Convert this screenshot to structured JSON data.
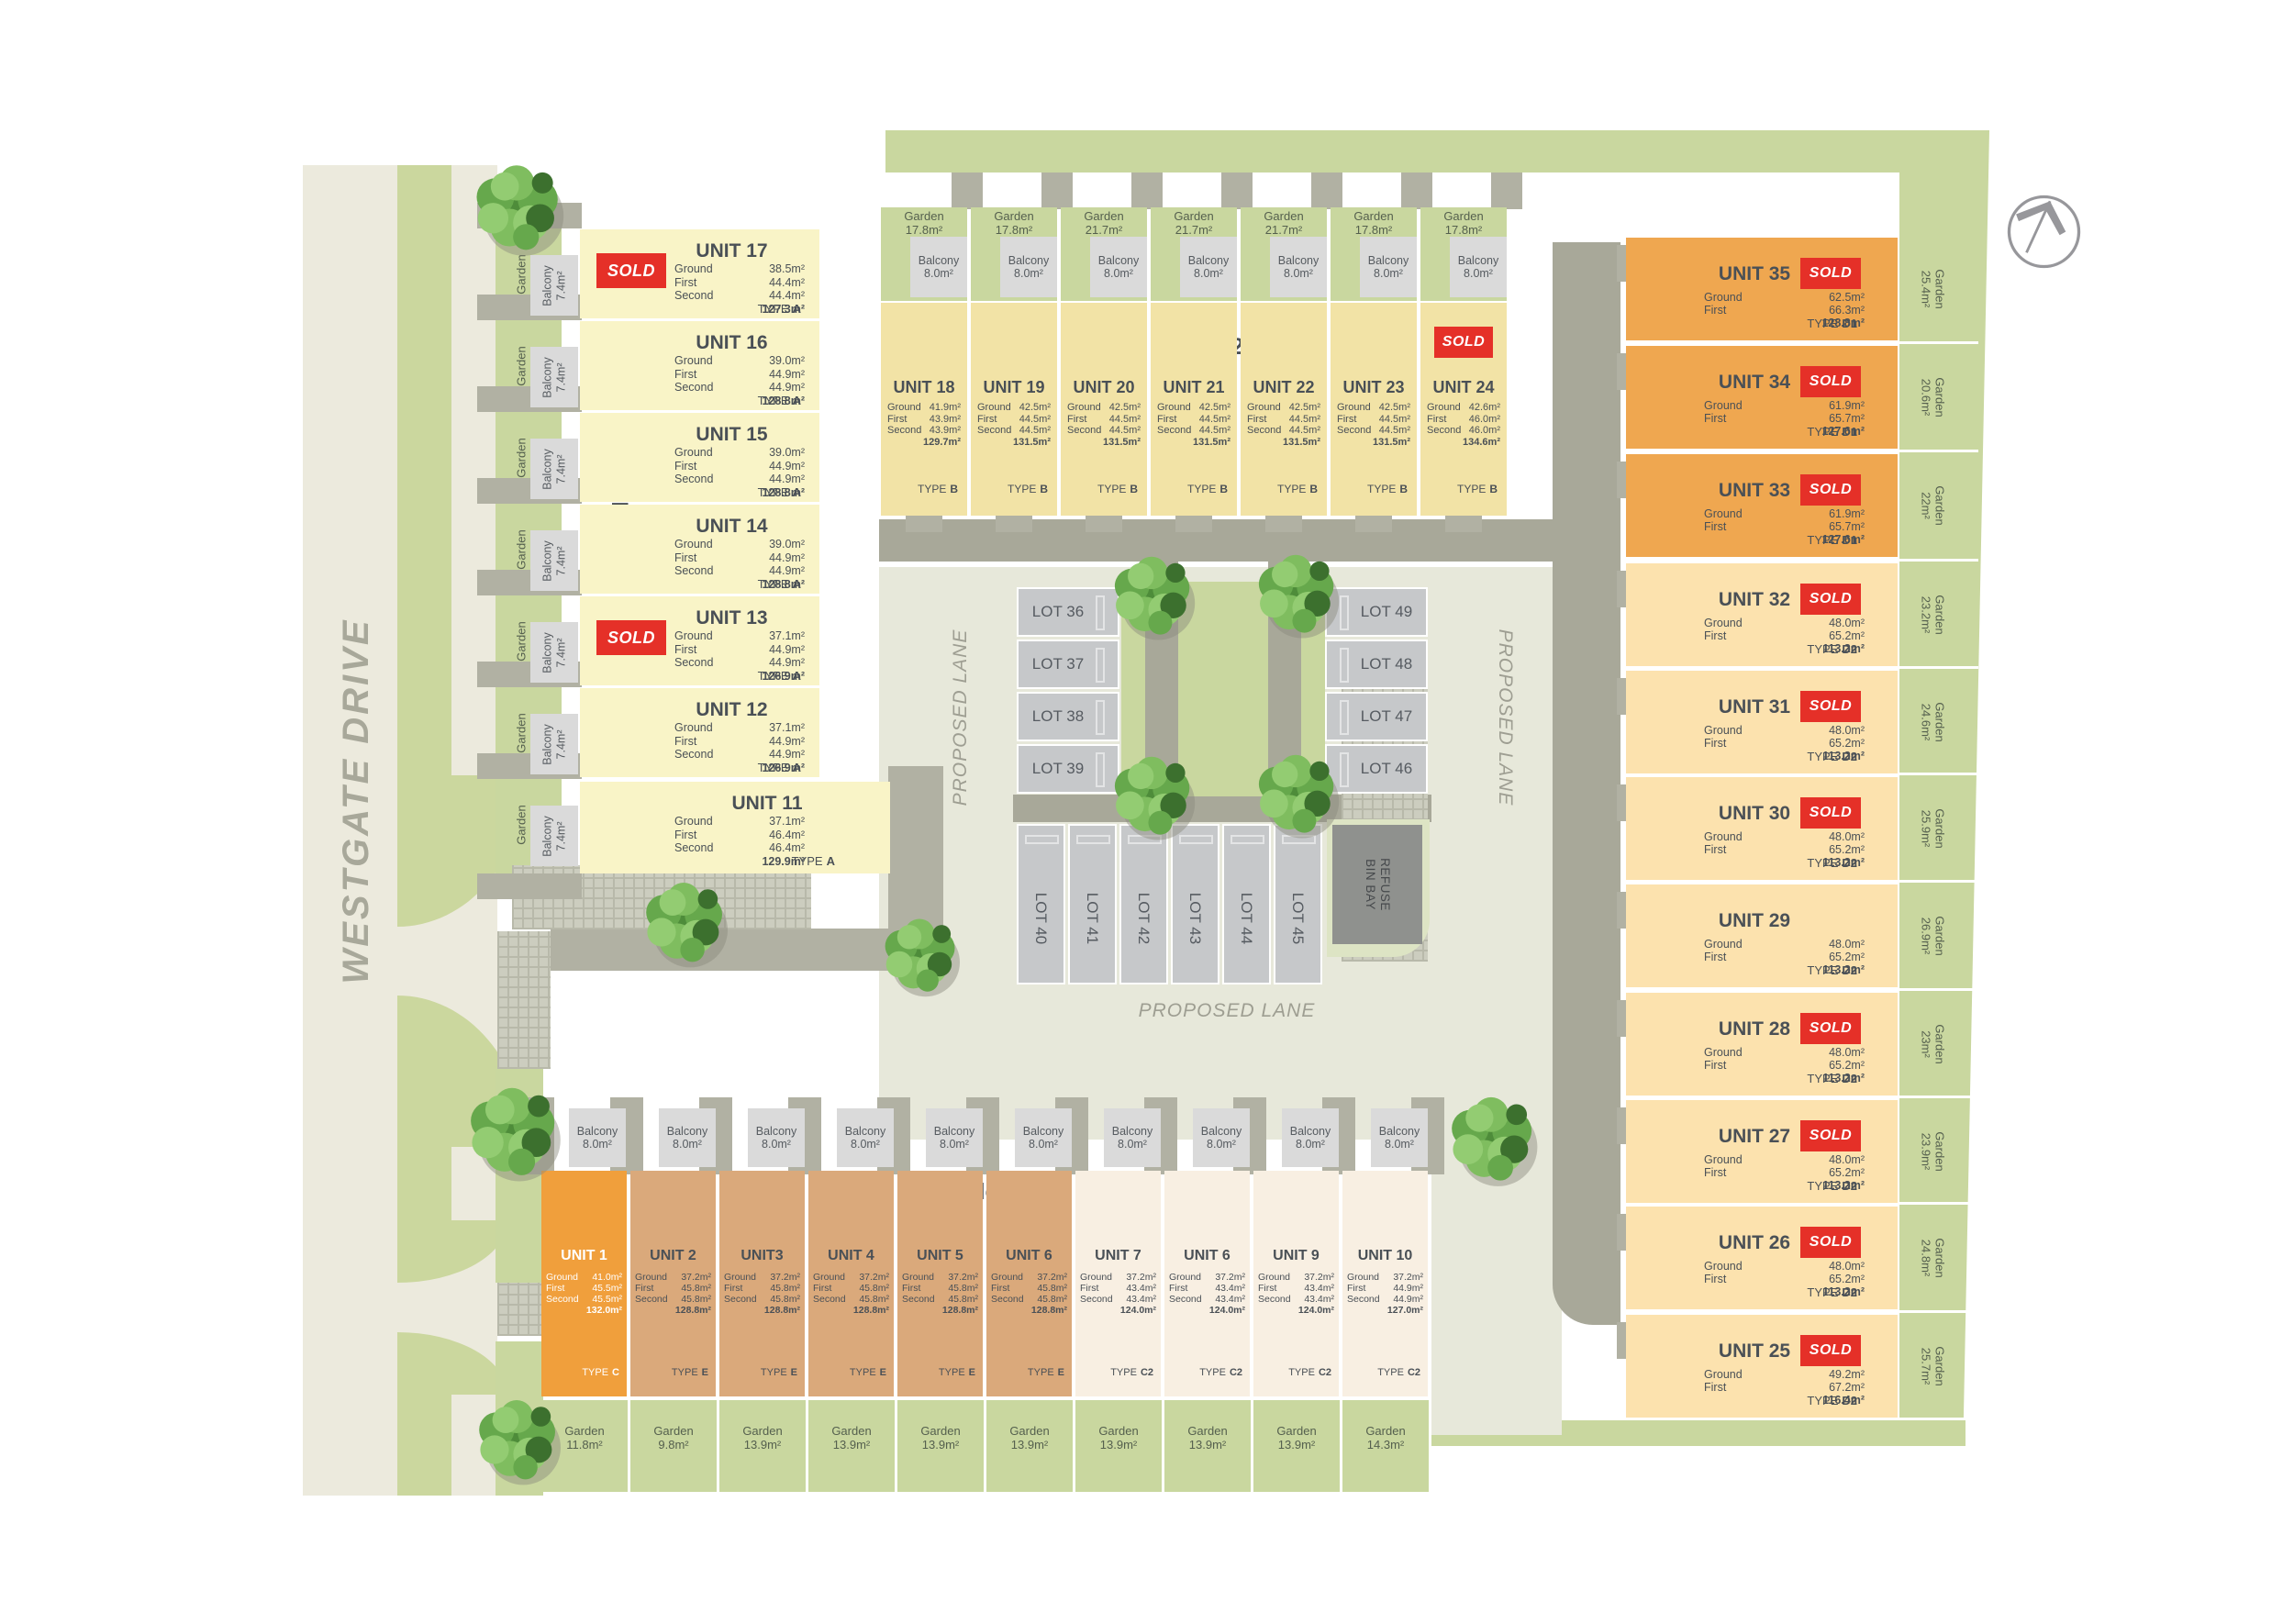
{
  "site": {
    "road_label": "WESTGATE DRIVE",
    "lane_left": "PROPOSED LANE",
    "lane_right": "PROPOSED LANE",
    "lane_bottom": "PROPOSED LANE",
    "refuse_line1": "REFUSE",
    "refuse_line2": "BIN BAY",
    "sold": "SOLD"
  },
  "labels": {
    "ground": "Ground",
    "first": "First",
    "second": "Second",
    "garden": "Garden",
    "balcony": "Balcony",
    "type": "TYPE"
  },
  "lots": {
    "left": [
      "LOT 36",
      "LOT 37",
      "LOT 38",
      "LOT 39"
    ],
    "right": [
      "LOT 49",
      "LOT 48",
      "LOT 47",
      "LOT 46"
    ],
    "bottom": [
      "LOT 40",
      "LOT 41",
      "LOT 42",
      "LOT 43",
      "LOT 44",
      "LOT 45"
    ]
  },
  "blocks": [
    {
      "label": "Block 1",
      "units": [
        {
          "name": "UNIT 17",
          "ground": "38.5m²",
          "first": "44.4m²",
          "second": "44.4m²",
          "total": "127.3m²",
          "type": "A",
          "sold": true,
          "garden": "21m²",
          "balcony": "7.4m²"
        },
        {
          "name": "UNIT 16",
          "ground": "39.0m²",
          "first": "44.9m²",
          "second": "44.9m²",
          "total": "128.8m²",
          "type": "A",
          "sold": false,
          "garden": "16m²",
          "balcony": "7.4m²"
        },
        {
          "name": "UNIT 15",
          "ground": "39.0m²",
          "first": "44.9m²",
          "second": "44.9m²",
          "total": "128.8m²",
          "type": "A",
          "sold": false,
          "garden": "16m²",
          "balcony": "7.4m²"
        },
        {
          "name": "UNIT 14",
          "ground": "39.0m²",
          "first": "44.9m²",
          "second": "44.9m²",
          "total": "128.8m²",
          "type": "A",
          "sold": false,
          "garden": "16m²",
          "balcony": "7.4m²"
        },
        {
          "name": "UNIT 13",
          "ground": "37.1m²",
          "first": "44.9m²",
          "second": "44.9m²",
          "total": "126.9m²",
          "type": "A",
          "sold": true,
          "garden": "16m²",
          "balcony": "7.4m²"
        },
        {
          "name": "UNIT 12",
          "ground": "37.1m²",
          "first": "44.9m²",
          "second": "44.9m²",
          "total": "126.9m²",
          "type": "A",
          "sold": false,
          "garden": "16m²",
          "balcony": "7.4m²"
        },
        {
          "name": "UNIT 11",
          "ground": "37.1m²",
          "first": "46.4m²",
          "second": "46.4m²",
          "total": "129.9m²",
          "type": "A",
          "sold": false,
          "garden": "16m²",
          "balcony": "7.4m²"
        }
      ]
    },
    {
      "label": "Block 2",
      "units": [
        {
          "name": "UNIT 18",
          "ground": "41.9m²",
          "first": "43.9m²",
          "second": "43.9m²",
          "total": "129.7m²",
          "type": "B",
          "sold": false,
          "garden": "17.8m²",
          "balcony": "8.0m²"
        },
        {
          "name": "UNIT 19",
          "ground": "42.5m²",
          "first": "44.5m²",
          "second": "44.5m²",
          "total": "131.5m²",
          "type": "B",
          "sold": false,
          "garden": "17.8m²",
          "balcony": "8.0m²"
        },
        {
          "name": "UNIT 20",
          "ground": "42.5m²",
          "first": "44.5m²",
          "second": "44.5m²",
          "total": "131.5m²",
          "type": "B",
          "sold": false,
          "garden": "21.7m²",
          "balcony": "8.0m²"
        },
        {
          "name": "UNIT 21",
          "ground": "42.5m²",
          "first": "44.5m²",
          "second": "44.5m²",
          "total": "131.5m²",
          "type": "B",
          "sold": false,
          "garden": "21.7m²",
          "balcony": "8.0m²"
        },
        {
          "name": "UNIT 22",
          "ground": "42.5m²",
          "first": "44.5m²",
          "second": "44.5m²",
          "total": "131.5m²",
          "type": "B",
          "sold": false,
          "garden": "21.7m²",
          "balcony": "8.0m²"
        },
        {
          "name": "UNIT 23",
          "ground": "42.5m²",
          "first": "44.5m²",
          "second": "44.5m²",
          "total": "131.5m²",
          "type": "B",
          "sold": false,
          "garden": "17.8m²",
          "balcony": "8.0m²"
        },
        {
          "name": "UNIT 24",
          "ground": "42.6m²",
          "first": "46.0m²",
          "second": "46.0m²",
          "total": "134.6m²",
          "type": "B",
          "sold": true,
          "garden": "17.8m²",
          "balcony": "8.0m²"
        }
      ]
    },
    {
      "label": "Block 3",
      "units": [
        {
          "name": "UNIT 1",
          "ground": "41.0m²",
          "first": "45.5m²",
          "second": "45.5m²",
          "total": "132.0m²",
          "type": "C",
          "sold": false,
          "garden": "11.8m²",
          "balcony": "8.0m²"
        },
        {
          "name": "UNIT 2",
          "ground": "37.2m²",
          "first": "45.8m²",
          "second": "45.8m²",
          "total": "128.8m²",
          "type": "E",
          "sold": false,
          "garden": "9.8m²",
          "balcony": "8.0m²"
        },
        {
          "name": "UNIT3",
          "ground": "37.2m²",
          "first": "45.8m²",
          "second": "45.8m²",
          "total": "128.8m²",
          "type": "E",
          "sold": false,
          "garden": "13.9m²",
          "balcony": "8.0m²"
        },
        {
          "name": "UNIT 4",
          "ground": "37.2m²",
          "first": "45.8m²",
          "second": "45.8m²",
          "total": "128.8m²",
          "type": "E",
          "sold": false,
          "garden": "13.9m²",
          "balcony": "8.0m²"
        },
        {
          "name": "UNIT 5",
          "ground": "37.2m²",
          "first": "45.8m²",
          "second": "45.8m²",
          "total": "128.8m²",
          "type": "E",
          "sold": false,
          "garden": "13.9m²",
          "balcony": "8.0m²"
        },
        {
          "name": "UNIT 6",
          "ground": "37.2m²",
          "first": "45.8m²",
          "second": "45.8m²",
          "total": "128.8m²",
          "type": "E",
          "sold": false,
          "garden": "13.9m²",
          "balcony": "8.0m²"
        },
        {
          "name": "UNIT 7",
          "ground": "37.2m²",
          "first": "43.4m²",
          "second": "43.4m²",
          "total": "124.0m²",
          "type": "C2",
          "sold": false,
          "garden": "13.9m²",
          "balcony": "8.0m²"
        },
        {
          "name": "UNIT 6",
          "ground": "37.2m²",
          "first": "43.4m²",
          "second": "43.4m²",
          "total": "124.0m²",
          "type": "C2",
          "sold": false,
          "garden": "13.9m²",
          "balcony": "8.0m²"
        },
        {
          "name": "UNIT 9",
          "ground": "37.2m²",
          "first": "43.4m²",
          "second": "43.4m²",
          "total": "124.0m²",
          "type": "C2",
          "sold": false,
          "garden": "13.9m²",
          "balcony": "8.0m²"
        },
        {
          "name": "UNIT 10",
          "ground": "37.2m²",
          "first": "44.9m²",
          "second": "44.9m²",
          "total": "127.0m²",
          "type": "C2",
          "sold": false,
          "garden": "14.3m²",
          "balcony": "8.0m²"
        }
      ]
    },
    {
      "label": "Block 4",
      "units": [
        {
          "name": "UNIT 35",
          "ground": "62.5m²",
          "first": "66.3m²",
          "total": "128.8m²",
          "type": "D1",
          "sold": true,
          "garden": "25.4m²"
        },
        {
          "name": "UNIT 34",
          "ground": "61.9m²",
          "first": "65.7m²",
          "total": "127.6m²",
          "type": "D1",
          "sold": true,
          "garden": "20.6m²"
        },
        {
          "name": "UNIT 33",
          "ground": "61.9m²",
          "first": "65.7m²",
          "total": "127.6m²",
          "type": "D1",
          "sold": true,
          "garden": "22m²"
        },
        {
          "name": "UNIT 32",
          "ground": "48.0m²",
          "first": "65.2m²",
          "total": "113.2m²",
          "type": "D2",
          "sold": true,
          "garden": "23.2m²"
        },
        {
          "name": "UNIT 31",
          "ground": "48.0m²",
          "first": "65.2m²",
          "total": "113.2m²",
          "type": "D2",
          "sold": true,
          "garden": "24.6m²"
        },
        {
          "name": "UNIT 30",
          "ground": "48.0m²",
          "first": "65.2m²",
          "total": "113.2m²",
          "type": "D2",
          "sold": true,
          "garden": "25.9m²"
        },
        {
          "name": "UNIT 29",
          "ground": "48.0m²",
          "first": "65.2m²",
          "total": "113.2m²",
          "type": "D2",
          "sold": false,
          "garden": "26.9m²"
        },
        {
          "name": "UNIT 28",
          "ground": "48.0m²",
          "first": "65.2m²",
          "total": "113.2m²",
          "type": "D2",
          "sold": true,
          "garden": "23m²"
        },
        {
          "name": "UNIT 27",
          "ground": "48.0m²",
          "first": "65.2m²",
          "total": "113.2m²",
          "type": "D2",
          "sold": true,
          "garden": "23.9m²"
        },
        {
          "name": "UNIT 26",
          "ground": "48.0m²",
          "first": "65.2m²",
          "total": "113.2m²",
          "type": "D2",
          "sold": true,
          "garden": "24.8m²"
        },
        {
          "name": "UNIT 25",
          "ground": "49.2m²",
          "first": "67.2m²",
          "total": "116.4m²",
          "type": "D2",
          "sold": true,
          "garden": "25.7m²"
        }
      ]
    }
  ]
}
